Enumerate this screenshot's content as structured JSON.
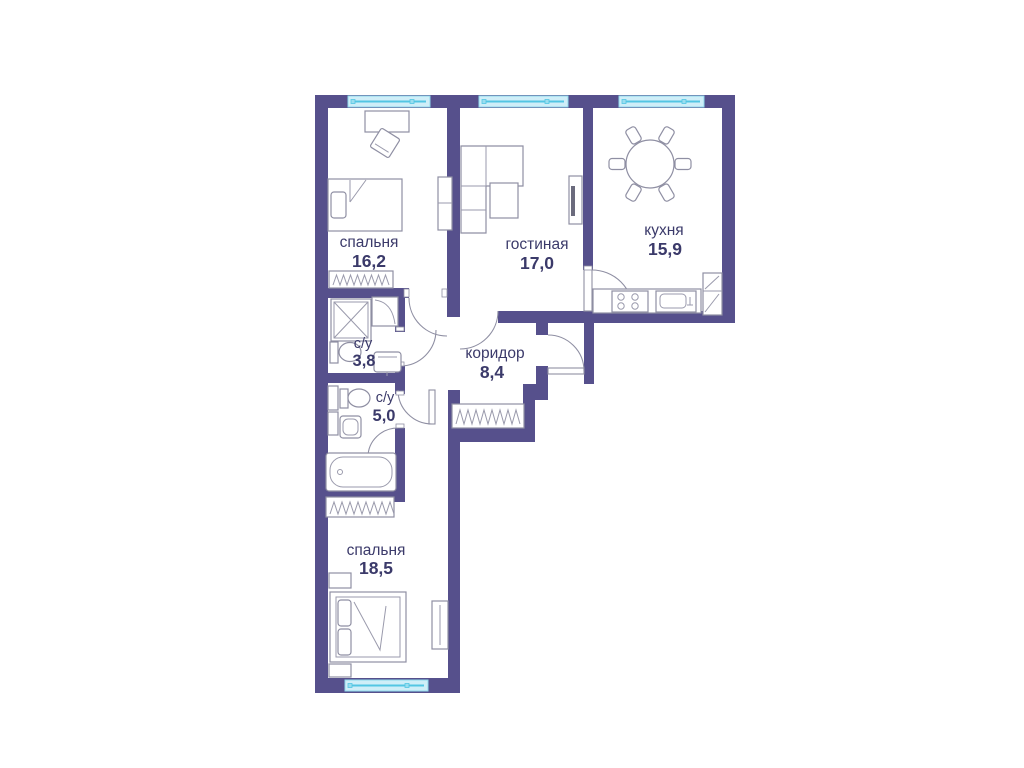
{
  "plan": {
    "type": "apartment-floor-plan",
    "rooms": [
      {
        "id": "bedroom1",
        "name": "спальня",
        "area": "16,2"
      },
      {
        "id": "living",
        "name": "гостиная",
        "area": "17,0"
      },
      {
        "id": "kitchen",
        "name": "кухня",
        "area": "15,9"
      },
      {
        "id": "bath1",
        "name": "с/у",
        "area": "3,8"
      },
      {
        "id": "bath2",
        "name": "с/у",
        "area": "5,0"
      },
      {
        "id": "corridor",
        "name": "коридор",
        "area": "8,4"
      },
      {
        "id": "bedroom2",
        "name": "спальня",
        "area": "18,5"
      }
    ],
    "colors": {
      "wall": "#56508C",
      "window_fill": "#cfeef8",
      "window_line": "#53c6e3",
      "furniture_stroke": "#8f8fa3",
      "label_text": "#3b3a6a",
      "background": "#ffffff"
    },
    "windows_count": 4,
    "doors_count": 7
  }
}
